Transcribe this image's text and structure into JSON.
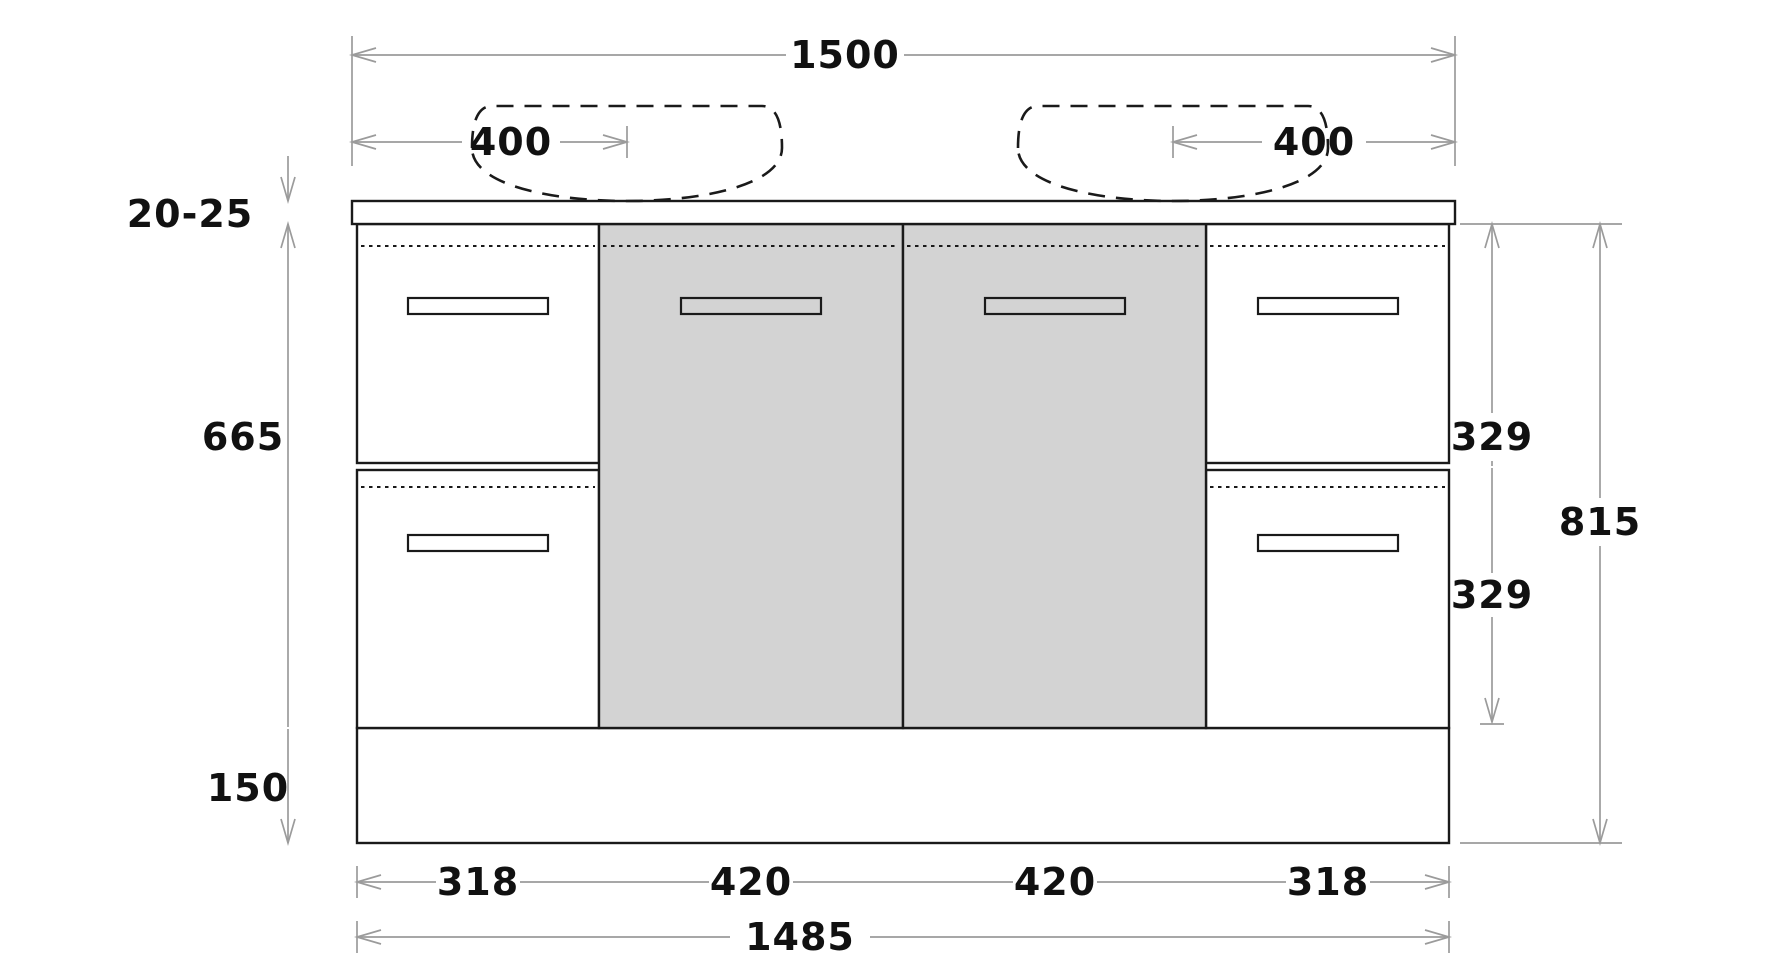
{
  "diagram": {
    "type": "vanity-cabinet-front-elevation",
    "dims": {
      "overall_width": "1500",
      "basin_left_offset": "400",
      "basin_right_offset": "400",
      "countertop_thickness": "20-25",
      "body_height": "665",
      "kickboard_height": "150",
      "upper_drawer_height": "329",
      "lower_drawer_height": "329",
      "overall_height": "815",
      "sections": [
        "318",
        "420",
        "420",
        "318"
      ],
      "base_width": "1485"
    },
    "colors": {
      "outline": "#1a1a1a",
      "dimension_line": "#9b9b9b",
      "door_fill": "#d3d3d3",
      "background": "#ffffff",
      "label_text": "#111111"
    }
  }
}
